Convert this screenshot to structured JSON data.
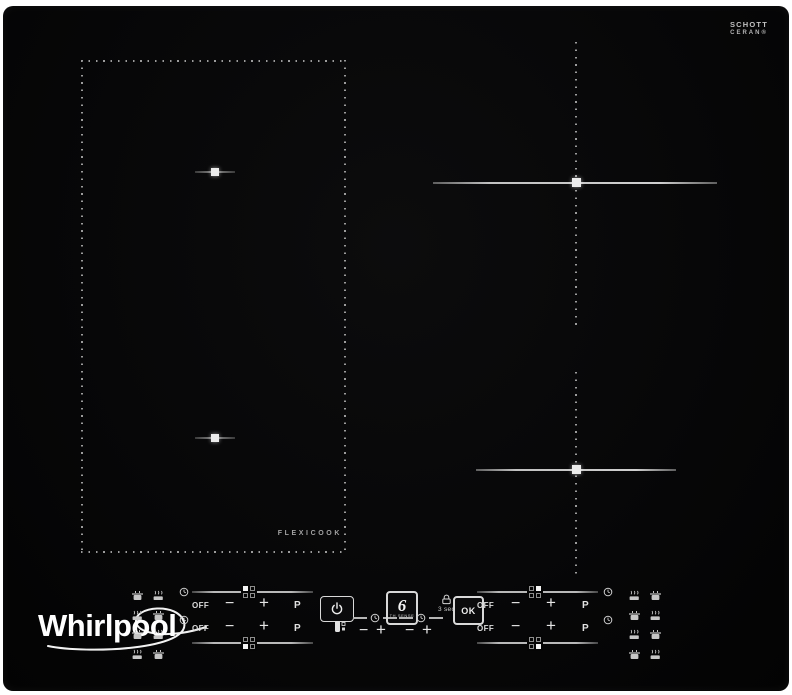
{
  "glass_brand": {
    "line1": "SCHOTT",
    "line2": "CERAN®"
  },
  "whirlpool_logo": "Whirlpool",
  "flexicook_label": "FLEXICOOK",
  "sliders": {
    "off": "OFF",
    "minus": "−",
    "plus": "+",
    "boost": "P"
  },
  "timer": {
    "minus": "−",
    "plus": "+"
  },
  "center": {
    "six": "6",
    "six_caption": "TH SENSE",
    "ok": "OK",
    "hold_hint": "3 sec"
  },
  "zone_indicator_filled": {
    "left_top_group": "rear-left",
    "left_bottom_group": "front-left",
    "right_top_group": "rear-right",
    "right_bottom_group": "front-right"
  },
  "icons": {
    "clock-icon": "⏱",
    "power-icon": "⏻",
    "key-lock-icon": "⚿",
    "padlock-icon": "🔒",
    "pot-icon": "🍲",
    "pan-icon": "🍳",
    "pot-marker-icon": "▪"
  },
  "colors": {
    "glass": "#070708",
    "guide_line": "#c2c2c2",
    "dotted_line": "#9c9c9c",
    "marker_square": "#ececec",
    "control_text": "#dcdcdc",
    "background": "#ffffff"
  }
}
